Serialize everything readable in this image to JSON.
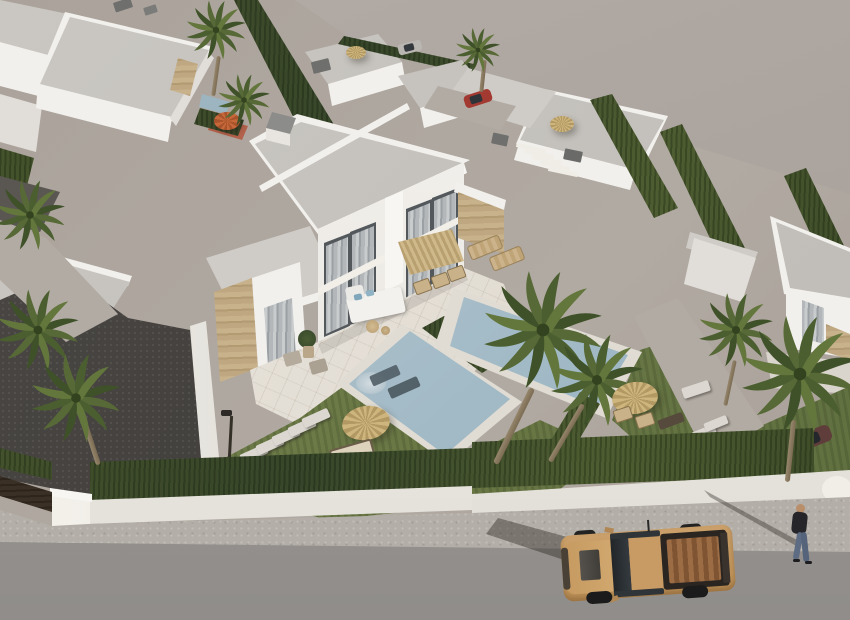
{
  "scene": {
    "type": "3d-architectural-rendering",
    "view": "aerial-perspective",
    "description": "Aerial 3D render of a modern white villa development: a two-storey duplex villa with floor-to-ceiling curtained windows and stone-clad accents, a tiled terrace with corner sofa and straw parasols, two rectangular private pools in lawned gardens with palm trees, dark gravel driveways with stepping stones, surrounded by similar flat-roofed white villas separated by tall cypress hedges; a white perimeter wall with hedge borders a sidewalk and grey road on which a sand-coloured pickup truck drives past a walking pedestrian.",
    "palette": {
      "backdrop": "#aba39d",
      "ground": "#aba39b",
      "roof_grey": "#c6c3be",
      "wall_white": "#f2f0ec",
      "wall_shade": "#e1ded9",
      "stone_clad": "#c0aa83",
      "window_glass": "#53585c",
      "curtain_grey": "#b3b7ba",
      "terrace_tile": "#e7e2da",
      "lawn_green": "#6d7b47",
      "hedge_green": "#42502a",
      "gravel_dark": "#43403d",
      "pool_water": "#a9bfca",
      "pool_coping": "#e0dcd4",
      "straw_parasol": "#c4ab73",
      "orange_parasol": "#c7683a",
      "sidewalk": "#b6b1aa",
      "road": "#9a9693",
      "truck_body": "#c59862",
      "truck_bed": "#9c6c45",
      "red_car": "#a33a32",
      "maroon_car": "#5f3d3a",
      "silver_car": "#b9b5b0",
      "skin": "#b98e6b",
      "jeans": "#5d6c83"
    },
    "objects": {
      "background_villas": {
        "count": 8,
        "style": "white flat-roof modern villas"
      },
      "main_villa": {
        "storeys": 2,
        "units": 2,
        "features": [
          "floor-to-ceiling windows with grey curtains",
          "stone-clad accent panels",
          "roof chimney",
          "white roof parapet",
          "corner lounge sofa with blue cushions",
          "square straw dining parasol",
          "outdoor dining chairs",
          "sun loungers",
          "potted plant"
        ]
      },
      "pools": {
        "count": 2,
        "shape": "rectangular",
        "features": [
          "steps",
          "in-water loungers",
          "white coping"
        ]
      },
      "garden": {
        "lawns": 4,
        "palm_trees_approx": 10,
        "straw_parasols": 3,
        "sun_loungers_approx": 8,
        "stepping_stone_paths": 2,
        "garden_lamp": 1,
        "orange_parasol": 1,
        "small_background_pool": 1
      },
      "perimeter": {
        "white_wall": true,
        "tall_hedge": true,
        "entrance_pillar": true,
        "dark_gate": true
      },
      "street": {
        "sidewalk": true,
        "road": true
      },
      "vehicles": [
        {
          "type": "pickup-truck",
          "color": "sand",
          "location": "road"
        },
        {
          "type": "car",
          "color": "red",
          "location": "background-driveway"
        },
        {
          "type": "car",
          "color": "silver",
          "location": "far-background"
        },
        {
          "type": "car",
          "color": "maroon",
          "location": "behind-palm-right"
        }
      ],
      "people": [
        {
          "type": "pedestrian",
          "location": "sidewalk",
          "clothing": "dark jacket and blue jeans"
        }
      ]
    }
  }
}
